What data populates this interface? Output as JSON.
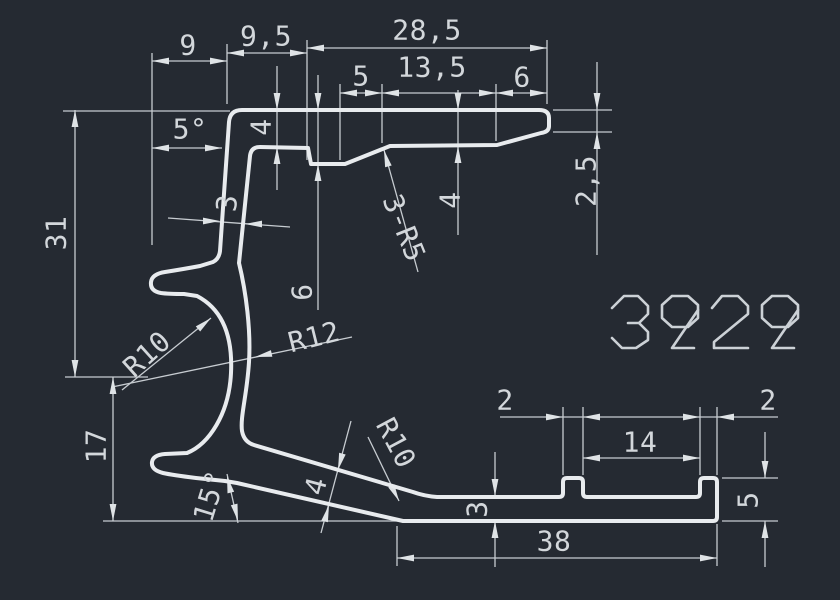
{
  "title_block": {
    "part_number": "3929"
  },
  "colors": {
    "background": "#252a32",
    "profile_line": "#e8ebee",
    "dimension_line": "#c7ccd1",
    "text": "#d3d7db"
  },
  "dims": {
    "w9": "9",
    "w95": "9,5",
    "w285": "28,5",
    "n5": "5",
    "n135": "13,5",
    "n6": "6",
    "a5": "5°",
    "t4_top": "4",
    "n6_depth": "6",
    "w3_wall": "3",
    "fillets": "3-R5",
    "t4_right": "4",
    "t25_tip": "2,5",
    "h31": "31",
    "h17": "17",
    "r10_hook": "R10",
    "r12_hook": "R12",
    "a15": "15°",
    "t4_arm": "4",
    "r10_arm": "R10",
    "tab2_left": "2",
    "tab2_right": "2",
    "gap14": "14",
    "base3": "3",
    "base38": "38",
    "lip5": "5"
  }
}
